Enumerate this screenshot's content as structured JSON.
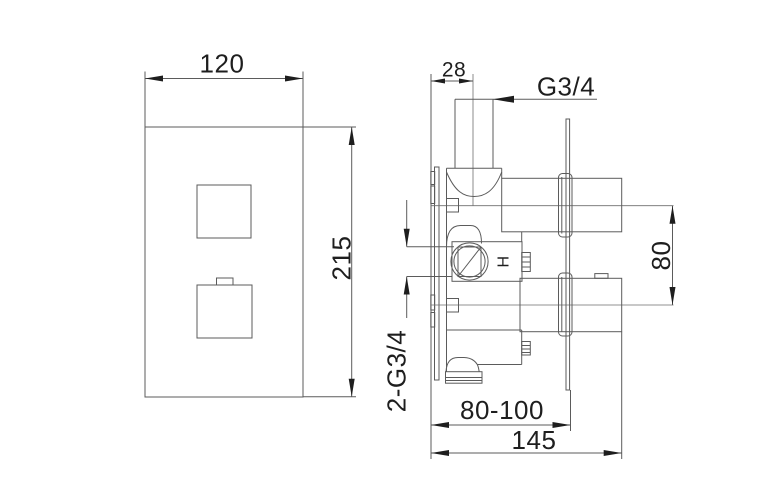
{
  "drawing": {
    "front_view": {
      "width": "120",
      "height": "215"
    },
    "side_view": {
      "pipe_offset": "28",
      "outlet_thread": "G3/4",
      "port_spacing": "80",
      "inlet_thread": "2-G3/4",
      "install_depth_range": "80-100",
      "total_depth": "145",
      "hot_marker": "H"
    }
  }
}
